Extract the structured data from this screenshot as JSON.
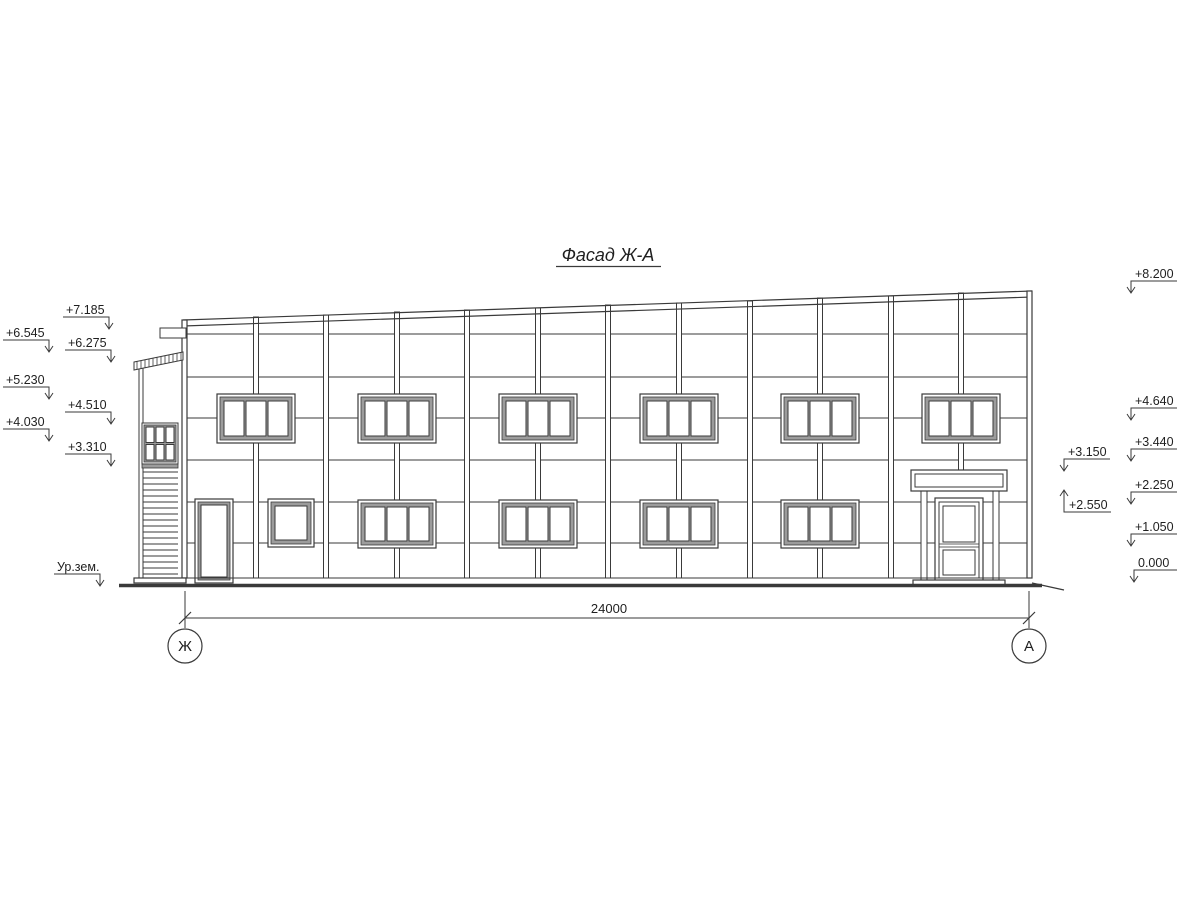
{
  "drawing": {
    "title": "Фасад Ж-А",
    "dimension_total": "24000",
    "axis_left": "Ж",
    "axis_right": "А",
    "ground_level_label": "Ур.зем.",
    "elevations_left": [
      "+7.185",
      "+6.545",
      "+6.275",
      "+5.230",
      "+4.510",
      "+4.030",
      "+3.310"
    ],
    "elevations_right": [
      "+8.200",
      "+4.640",
      "+3.440",
      "+2.250",
      "+1.050",
      "0.000"
    ],
    "elevations_canopy": [
      "+3.150",
      "+2.550"
    ],
    "colors": {
      "line": "#3a3a3a",
      "window_frame_fill": "#9c9c9c",
      "background": "#ffffff",
      "text": "#1f1f1f"
    }
  }
}
